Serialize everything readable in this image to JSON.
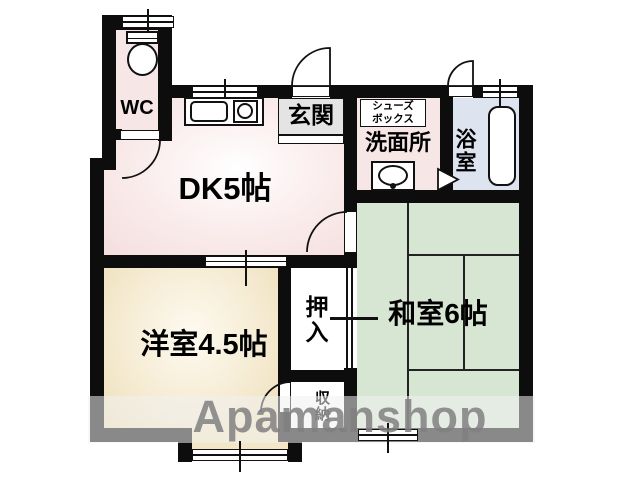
{
  "title": "apartment-floorplan",
  "rooms": {
    "wc": {
      "label": "WC"
    },
    "dk": {
      "label": "DK5帖"
    },
    "genkan": {
      "label": "玄関"
    },
    "shoes_box": {
      "line1": "シューズ",
      "line2": "ボックス"
    },
    "washroom": {
      "label": "洗面所"
    },
    "bathroom": {
      "label": "浴室"
    },
    "japanese_room": {
      "label": "和室6帖"
    },
    "western_room": {
      "label": "洋室4.5帖"
    },
    "closet": {
      "label": "押入"
    },
    "storage": {
      "label": "収納"
    }
  },
  "watermark": {
    "text": "Apamanshop"
  },
  "fixtures": [
    "toilet-icon",
    "kitchen-sink-icon",
    "stove-burner-icon",
    "washbasin-icon",
    "bathtub-icon",
    "folding-door-marker",
    "door-swing-arc",
    "window-symbol",
    "sliding-door-symbol"
  ],
  "colors": {
    "wall": "#0d0d0d",
    "dk_fill": "#f7e3e3",
    "wc_fill": "#f6e6e6",
    "washroom_fill": "#f7e6e6",
    "western_room_fill": "#f4e8cc",
    "japanese_room_fill": "#d7e6d3",
    "bathroom_fill": "#dde4f0",
    "genkan_fill": "#e4e4e4",
    "watermark_text": "#808080"
  }
}
